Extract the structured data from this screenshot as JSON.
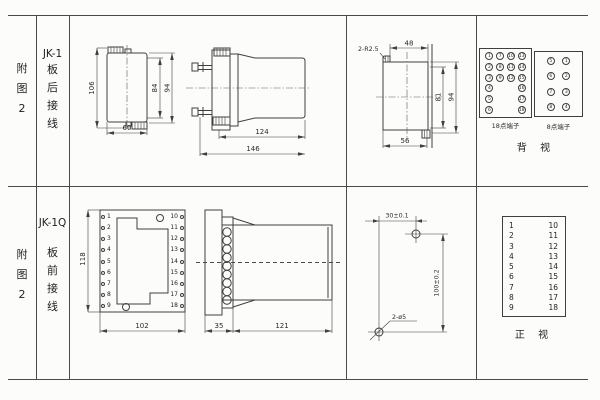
{
  "colors": {
    "line": "#3f3f3f",
    "text": "#2a2a2a",
    "background": "#fcfcfb"
  },
  "top_row": {
    "fig_chars": [
      "附",
      "图",
      "2"
    ],
    "model": "JK-1",
    "wiring_chars": [
      "板",
      "后",
      "接",
      "线"
    ],
    "d1": {
      "h_overall": "106",
      "h_inner": "84",
      "h_outer": "94",
      "w_bottom": "60"
    },
    "d2": {
      "body_len": "124",
      "overall_len": "146"
    },
    "d3": {
      "radius_note": "2-R2.5",
      "top_w": "48",
      "h_inner": "81",
      "h_outer": "94",
      "bottom_w": "56"
    },
    "rear_view": {
      "terminal18": {
        "label": "18点端子",
        "cells": [
          "1",
          "7",
          "10",
          "13",
          "2",
          "8",
          "11",
          "14",
          "3",
          "9",
          "12",
          "15",
          "4",
          "",
          "",
          "16",
          "5",
          "",
          "",
          "17",
          "6",
          "",
          "",
          "18"
        ]
      },
      "terminal8": {
        "label": "8点端子",
        "cells": [
          "5",
          "1",
          "6",
          "2",
          "7",
          "3",
          "8",
          "4"
        ]
      },
      "caption": "背 视"
    }
  },
  "bottom_row": {
    "fig_chars": [
      "附",
      "图",
      "2"
    ],
    "model": "JK-1Q",
    "wiring_chars": [
      "板",
      "前",
      "接",
      "线"
    ],
    "d4": {
      "height": "118",
      "width": "102"
    },
    "d5": {
      "plate_w": "35",
      "body_len": "121"
    },
    "d6": {
      "hole_spacing_h": "30±0.1",
      "hole_spacing_v": "100±0.2",
      "hole_note": "2-ø5"
    },
    "front_plate": {
      "left_terminals": [
        "1",
        "2",
        "3",
        "4",
        "5",
        "6",
        "7",
        "8",
        "9"
      ],
      "right_terminals": [
        "10",
        "11",
        "12",
        "13",
        "14",
        "15",
        "16",
        "17",
        "18"
      ]
    },
    "front_view_table": {
      "left": [
        "1",
        "2",
        "3",
        "4",
        "5",
        "6",
        "7",
        "8",
        "9"
      ],
      "right": [
        "10",
        "11",
        "12",
        "13",
        "14",
        "15",
        "16",
        "17",
        "18"
      ],
      "caption": "正 视"
    }
  }
}
